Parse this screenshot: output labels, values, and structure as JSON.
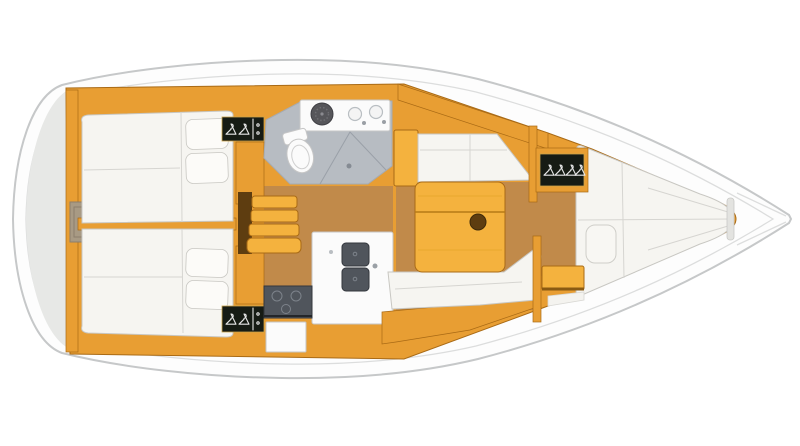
{
  "meta": {
    "description": "Top-down interior layout plan of a sailing yacht, bow pointing right, no text labels",
    "visible_text": "none"
  },
  "colors": {
    "background": "#ffffff",
    "deck-white": "#fdfdfd",
    "hull-stroke": "#c6c8c9",
    "deck-line": "#dcdddd",
    "transom-gray": "#e7e8e6",
    "wood": "#e89e33",
    "wood-bright": "#f4b23e",
    "wood-dark": "#a96a15",
    "wood-deep": "#5e3d10",
    "floor": "#c18a4a",
    "cushion": "#f6f5f1",
    "pillow": "#fcfbf8",
    "cushion-stroke": "#c8c7c2",
    "seam": "#d6d5d1",
    "head-floor": "#b7bcc2",
    "head-floor-stroke": "#a6abb2",
    "shower-line": "#9aa0a8",
    "fixture-white": "#fbfbfb",
    "fixture-stroke": "#c6c6c6",
    "appliance-dark": "#50555c",
    "appliance-deep": "#33373d",
    "appliance-light": "#7d838b",
    "locker-dark": "#161b14",
    "locker-frame": "#c9a24a",
    "hanger-white": "#e8e8e8"
  },
  "areas": {
    "stern": [
      "transom platform",
      "engine access hatch"
    ],
    "aft_cabin_port": [
      "double berth",
      "two pillows",
      "hanging locker with 2 hangers"
    ],
    "aft_cabin_starboard": [
      "double berth",
      "two pillows",
      "hanging locker with 2 hangers"
    ],
    "companionway": [
      "4 wooden steps",
      "engine panel"
    ],
    "head": [
      "toilet",
      "round washbasin",
      "twin-bowl sink unit",
      "shower drain"
    ],
    "galley": [
      "double sink",
      "two-burner stove",
      "oven front",
      "white counter"
    ],
    "saloon": [
      "port settee",
      "folding table with cup holder",
      "starboard settee"
    ],
    "forward_cabin": [
      "V-berth",
      "infill cushion",
      "hanging locker with 4 hangers",
      "entry step"
    ],
    "bow": [
      "anchor locker deck lines"
    ]
  },
  "counts": {
    "berths": 3,
    "hanging_lockers": 3,
    "steps": 4,
    "sink_bowls_galley": 2,
    "basins_head": 3
  }
}
